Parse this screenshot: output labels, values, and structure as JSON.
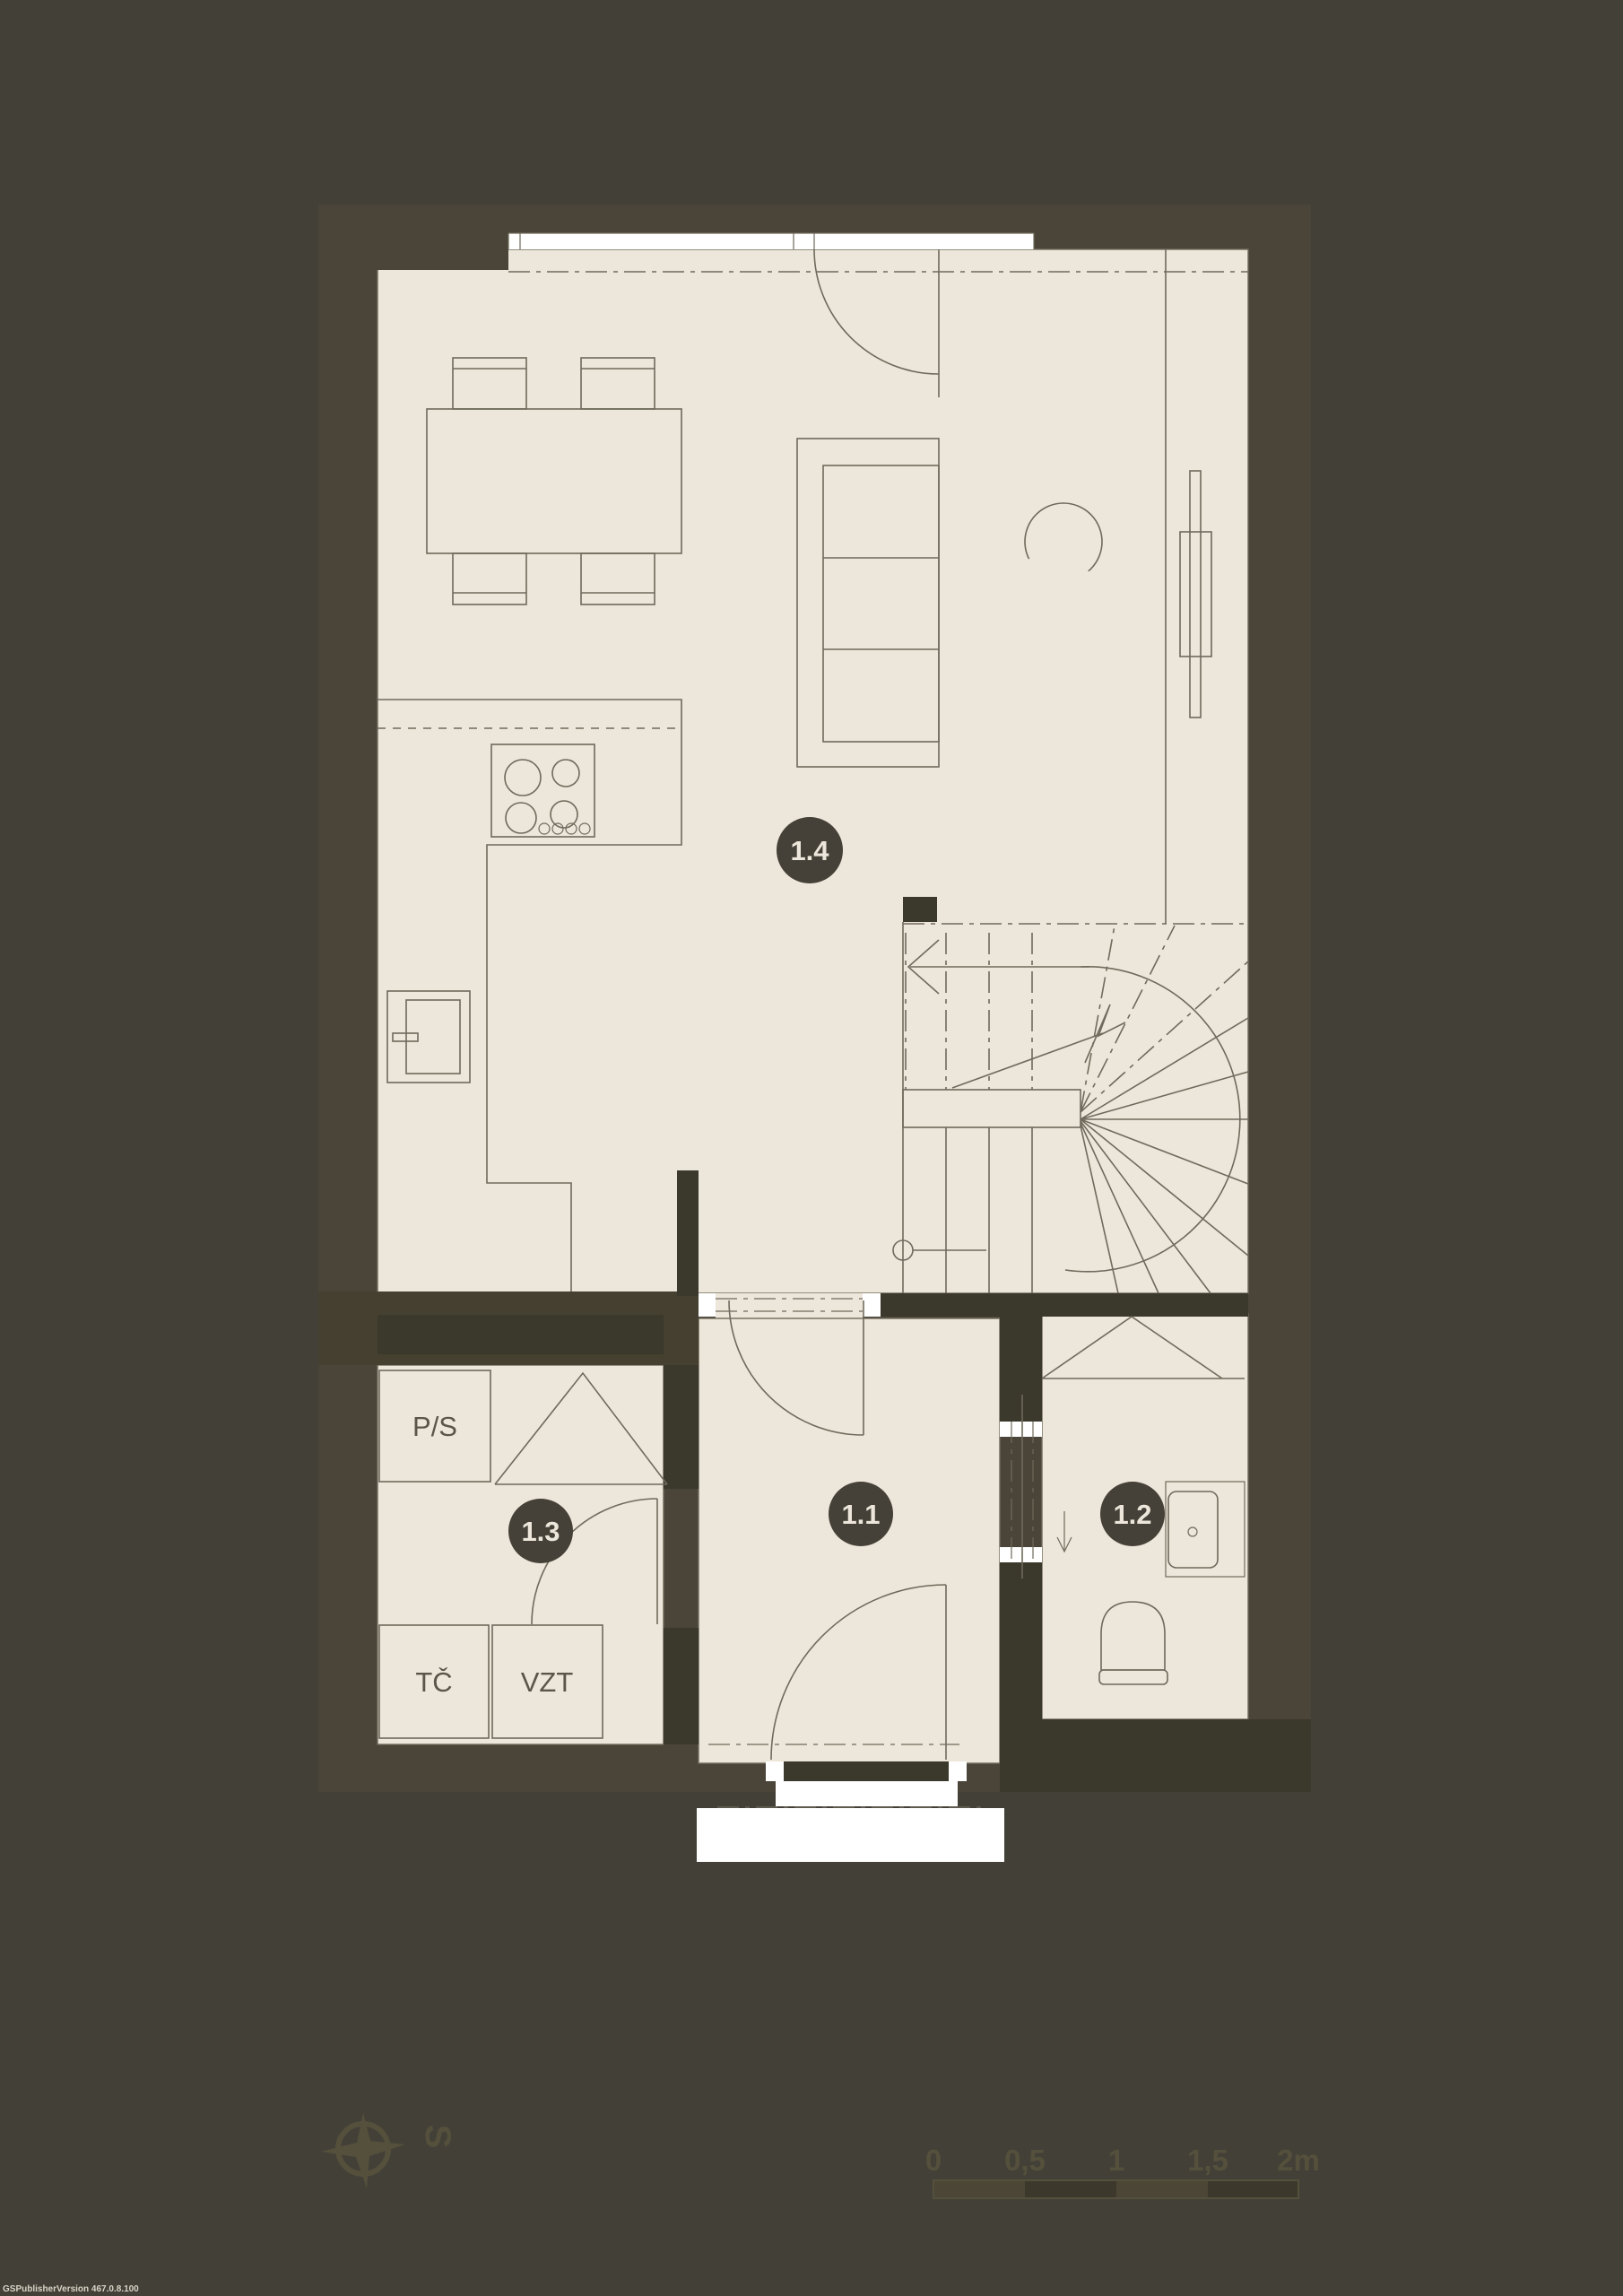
{
  "plan_title": "ground-floor-plan",
  "rooms": {
    "r11": "1.1",
    "r12": "1.2",
    "r13": "1.3",
    "r14": "1.4"
  },
  "equipment": {
    "ps": "P/S",
    "tc": "TČ",
    "vzt": "VZT"
  },
  "compass": {
    "north_label": "S"
  },
  "scale_bar": {
    "tick0": "0",
    "tick05": "0,5",
    "tick1": "1",
    "tick15": "1,5",
    "tick2": "2m"
  },
  "watermark": {
    "text": "GSPublisherVersion 467.0.8.100"
  },
  "colors": {
    "bg": "#434038",
    "wall": "#4A4538",
    "wall_mid": "#45402F",
    "wall_dark": "#3B382C",
    "floor": "#EDE6DA",
    "line": "#6F6A5B",
    "marker": "#454138",
    "label": "#5C564A",
    "subtle": "#55503C",
    "seg_dark": "#3C382B",
    "seg_light": "#4B4635",
    "paper": "#FFFFFF",
    "wm": "#D8D3C6"
  }
}
